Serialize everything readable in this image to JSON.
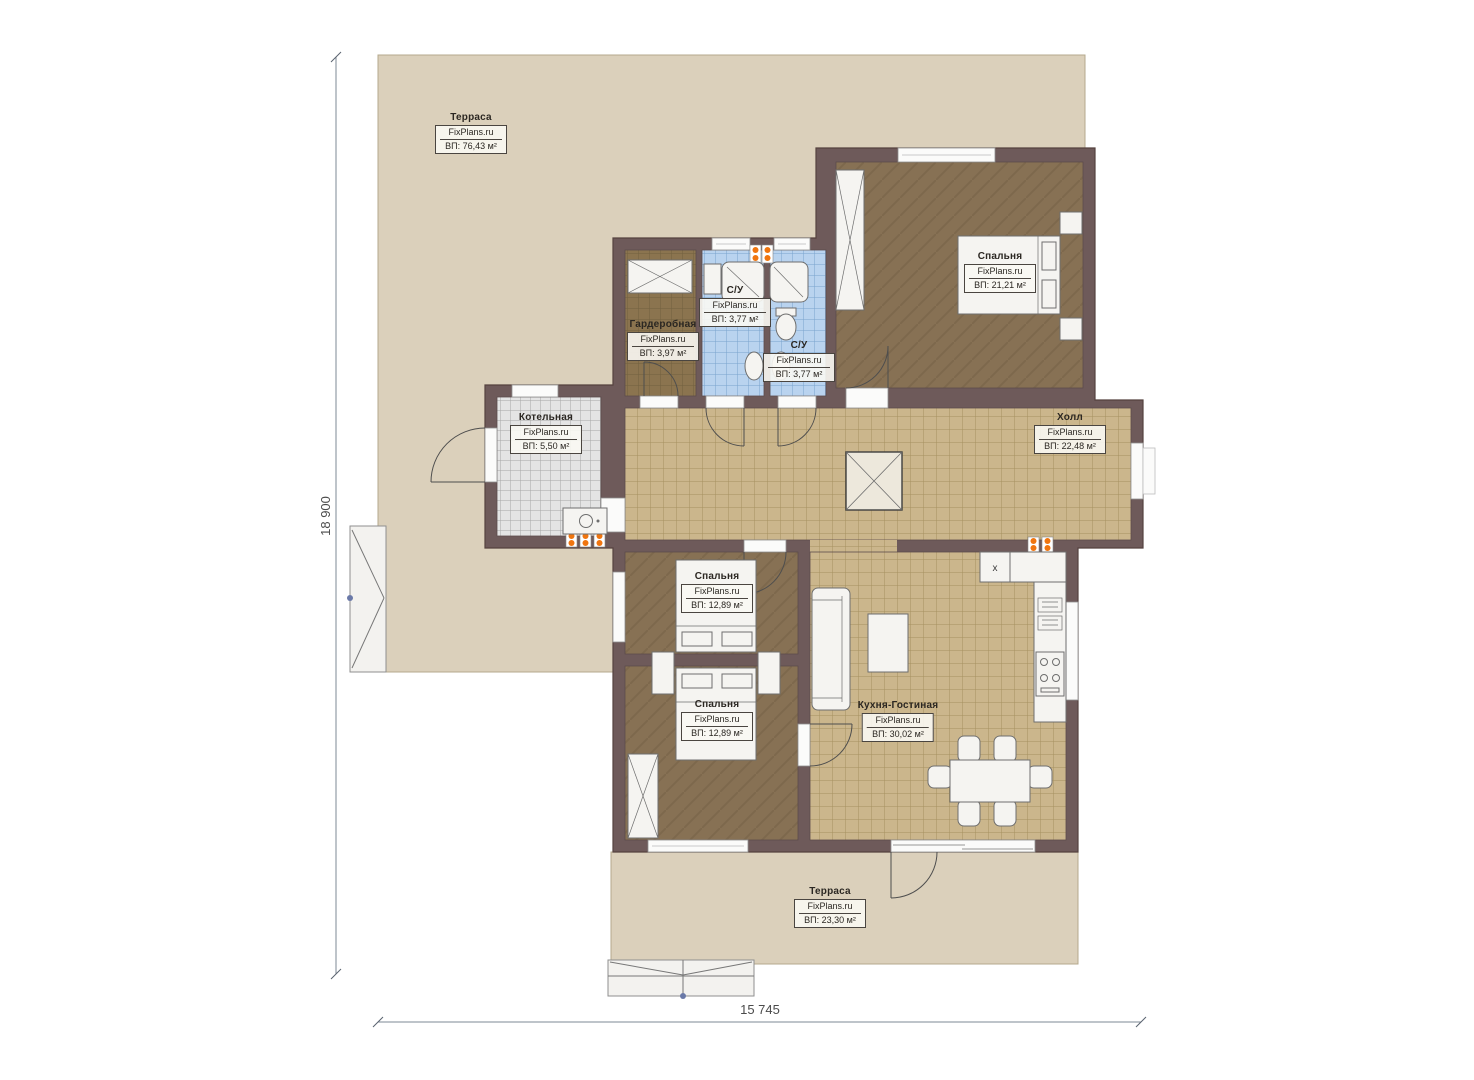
{
  "plan": {
    "watermark": "FixPlans.ru",
    "rooms": [
      {
        "id": "terrace-top",
        "name": "Терраса",
        "area": "ВП: 76,43 м²"
      },
      {
        "id": "bedroom-master",
        "name": "Спальня",
        "area": "ВП: 21,21 м²"
      },
      {
        "id": "wardrobe",
        "name": "Гардеробная",
        "area": "ВП: 3,97 м²"
      },
      {
        "id": "bathroom-top",
        "name": "С/У",
        "area": "ВП: 3,77 м²"
      },
      {
        "id": "bathroom-lower",
        "name": "С/У",
        "area": "ВП: 3,77 м²"
      },
      {
        "id": "boiler",
        "name": "Котельная",
        "area": "ВП: 5,50 м²"
      },
      {
        "id": "hall",
        "name": "Холл",
        "area": "ВП: 22,48 м²"
      },
      {
        "id": "bedroom-2",
        "name": "Спальня",
        "area": "ВП: 12,89 м²"
      },
      {
        "id": "bedroom-3",
        "name": "Спальня",
        "area": "ВП: 12,89 м²"
      },
      {
        "id": "kitchen-living",
        "name": "Кухня-Гостиная",
        "area": "ВП: 30,02 м²"
      },
      {
        "id": "terrace-bottom",
        "name": "Терраса",
        "area": "ВП: 23,30 м²"
      }
    ],
    "dimensions": {
      "height_label": "18 900",
      "width_label": "15 745"
    },
    "marks": {
      "fridge": "x"
    },
    "colors": {
      "wall": "#6E5A5A",
      "terrace": "#DBD0BB",
      "wood_floor": "#877154",
      "tile_floor": "#CBB68C",
      "bath_tile": "#B9D3EF",
      "boiler_tile": "#E4E4E4",
      "radiator": "#F0750F",
      "furniture": "#F5F4F1"
    }
  }
}
